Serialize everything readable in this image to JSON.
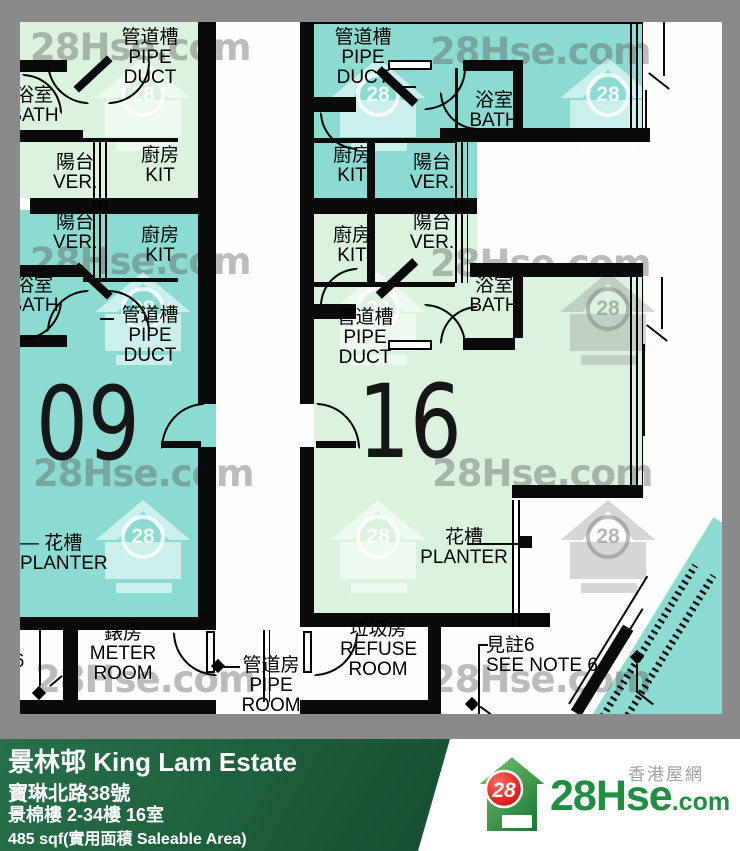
{
  "watermark": {
    "site": "28Hse.com",
    "badge": "28"
  },
  "labels": {
    "pipe_duct": "管道槽\nPIPE\nDUCT",
    "bath": "浴室\nBATH",
    "kitchen": "廚房\nKIT",
    "verandah": "陽台\nVER.",
    "planter_left": "— 花槽\nPLANTER",
    "planter_right": "花槽\nPLANTER",
    "meter_room": "錶房\nMETER\nROOM",
    "pipe_room": "管道房\nPIPE\nROOM",
    "refuse_room": "垃圾房\nREFUSE\nROOM",
    "see_note": "見註6\nSEE NOTE 6",
    "note_ref": "6"
  },
  "units": {
    "left": {
      "number": "09"
    },
    "right": {
      "number": "16"
    }
  },
  "footer": {
    "estate": "景林邨 King Lam Estate",
    "address": "寶琳北路38號",
    "block_floor_flat": "景棉樓 2-34樓 16室",
    "area": "485 sqf(實用面積 Saleable Area)",
    "site_name_cn": "香港屋網",
    "site_logo_text": "28Hse",
    "site_logo_suffix": ".com",
    "logo_badge": "28"
  },
  "colors": {
    "unit_teal": "#8CDBD2",
    "unit_pale_green": "#DAF2DE",
    "wall_black": "#0A0A0A",
    "canvas_gray": "#8A8A8A",
    "footer_green": "#1D5E3B",
    "logo_green": "#1F8F3F",
    "logo_red": "#E8251F"
  }
}
